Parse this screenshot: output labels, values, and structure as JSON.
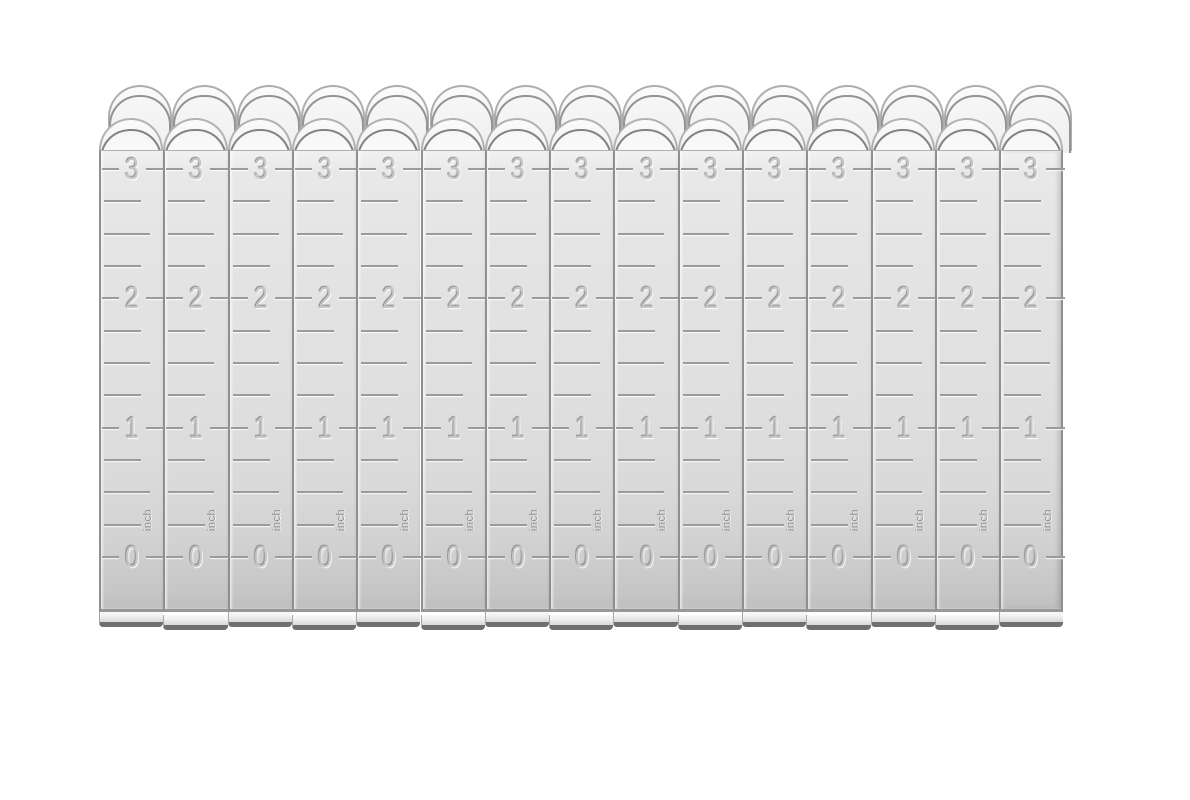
{
  "photo": {
    "background": "#ffffff",
    "ruler_count": 15,
    "unit_label": "inch",
    "inch_labels": [
      "3",
      "2",
      "1",
      "0"
    ],
    "colors": {
      "metal_light": "#f2f2f2",
      "metal_mid": "#dfdfdf",
      "metal_dark": "#c0c0c0",
      "marking": "#9b9b9b",
      "digit": "#c6c6c6",
      "edge_line": "#8f8f8f",
      "dome_arc": "#838383",
      "bottom_edge": "#6f6f6f"
    }
  }
}
